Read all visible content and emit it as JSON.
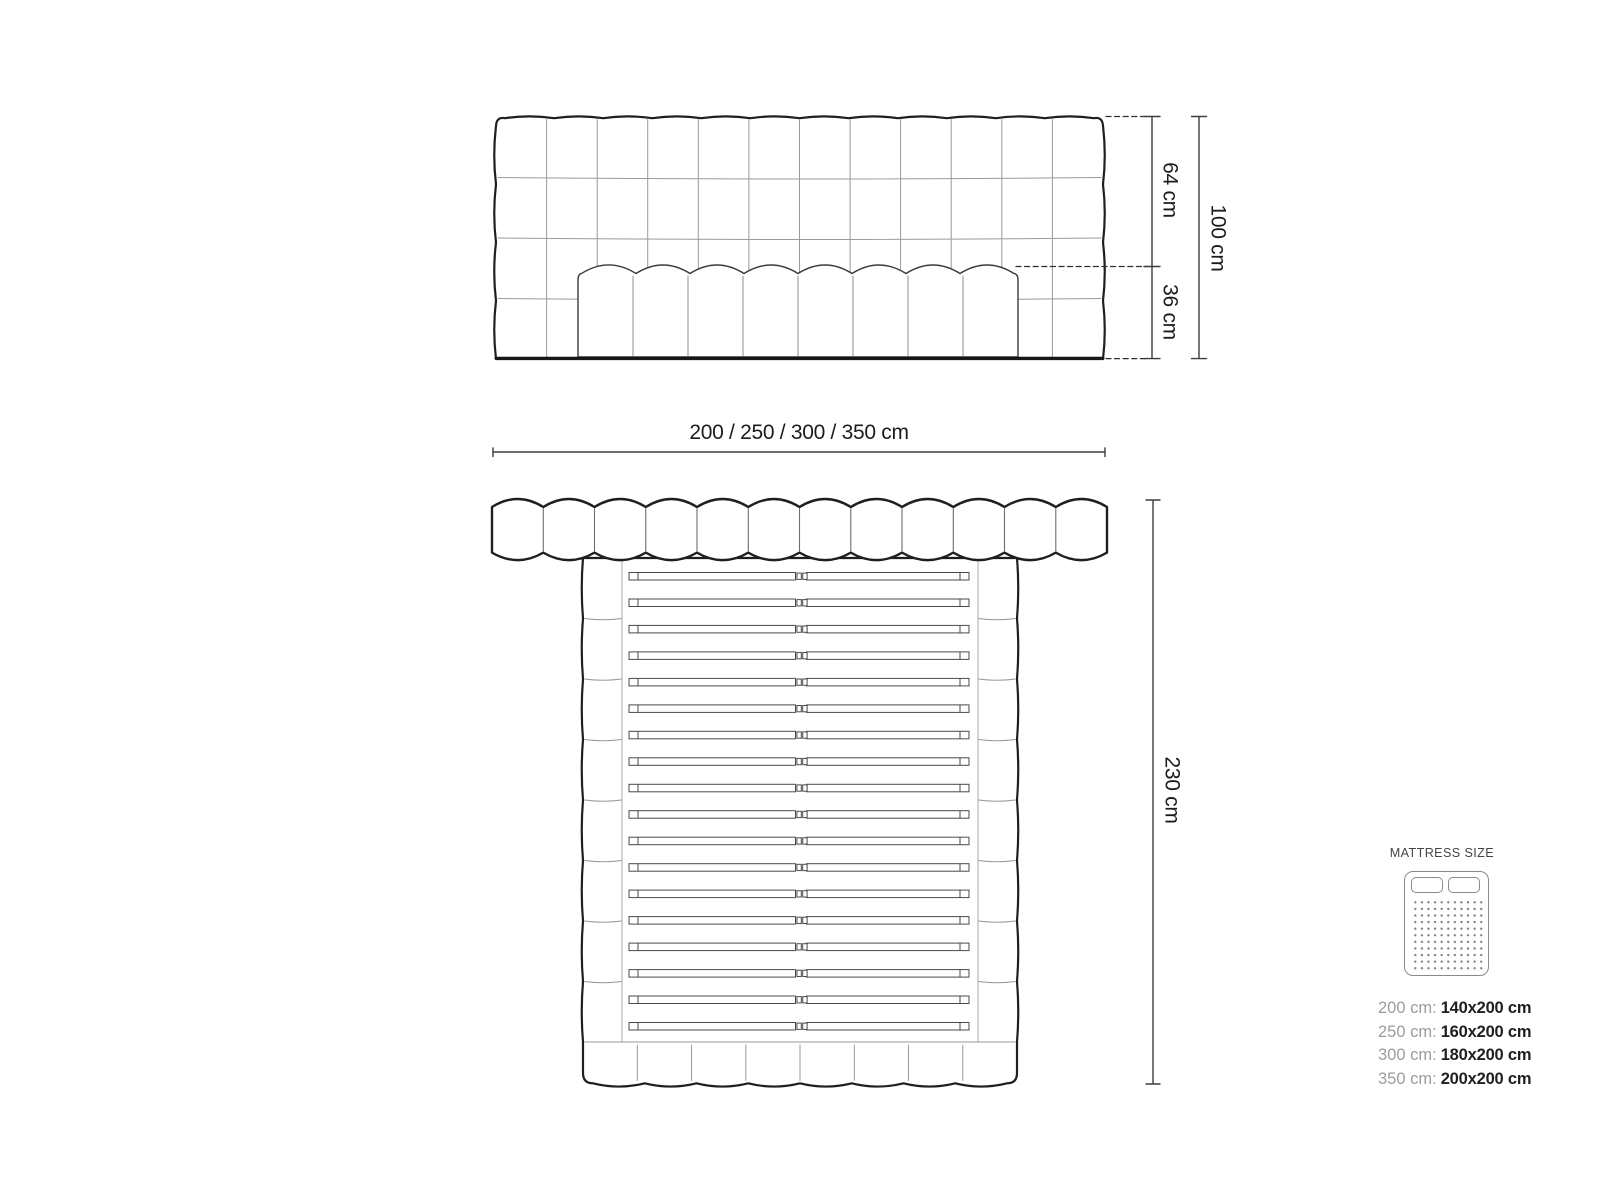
{
  "diagram": {
    "front_view": {
      "height_upper": "64 cm",
      "height_lower": "36 cm",
      "height_total": "100 cm"
    },
    "width_options": "200 / 250 / 300 / 350 cm",
    "top_view": {
      "length": "230 cm"
    }
  },
  "legend": {
    "title": "MATTRESS SIZE",
    "sizes": [
      {
        "bed": "200 cm:",
        "mattress": "140x200 cm"
      },
      {
        "bed": "250 cm:",
        "mattress": "160x200 cm"
      },
      {
        "bed": "300 cm:",
        "mattress": "180x200 cm"
      },
      {
        "bed": "350 cm:",
        "mattress": "200x200 cm"
      }
    ]
  },
  "colors": {
    "outline": "#1f1f1f",
    "seam": "#999999",
    "dimension": "#3d3d3d",
    "muted_text": "#9c9c9c",
    "dark_text": "#1f1f1f"
  }
}
